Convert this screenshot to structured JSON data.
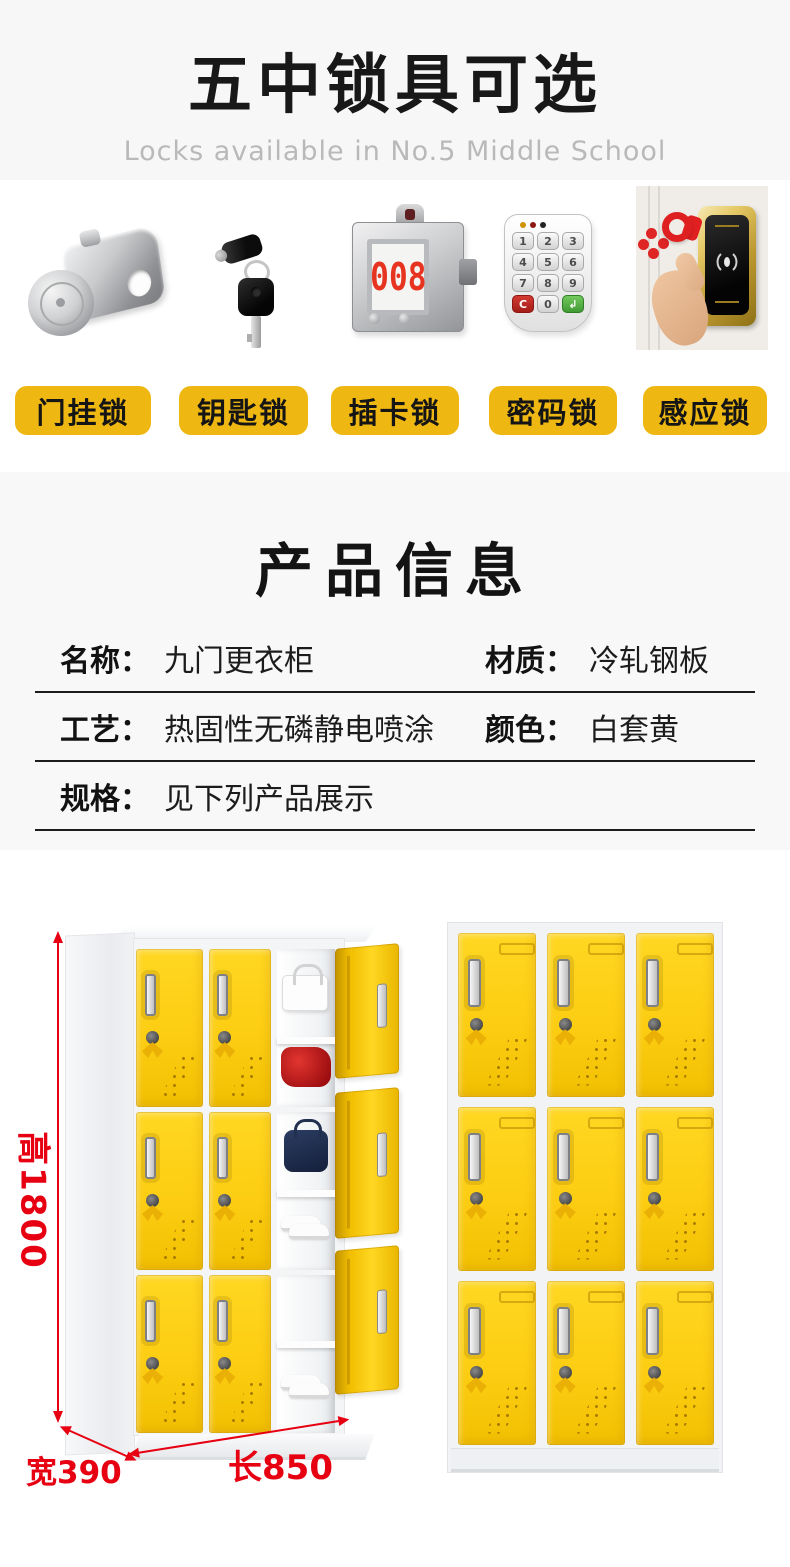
{
  "header": {
    "title": "五中锁具可选",
    "subtitle": "Locks available in No.5 Middle School"
  },
  "locks": {
    "items": [
      {
        "label": "门挂锁",
        "icon": "hasp-lock"
      },
      {
        "label": "钥匙锁",
        "icon": "key-lock"
      },
      {
        "label": "插卡锁",
        "icon": "card-lock"
      },
      {
        "label": "密码锁",
        "icon": "keypad-lock"
      },
      {
        "label": "感应锁",
        "icon": "rfid-lock"
      }
    ],
    "card_lock_number": "008",
    "keypad_keys": [
      "1",
      "2",
      "3",
      "4",
      "5",
      "6",
      "7",
      "8",
      "9",
      "C",
      "0",
      "↲"
    ]
  },
  "product_info": {
    "title": "产品信息",
    "rows": [
      {
        "label": "名称：",
        "value": "九门更衣柜"
      },
      {
        "label": "材质：",
        "value": "冷轧钢板"
      },
      {
        "label": "工艺：",
        "value": "热固性无磷静电喷涂"
      },
      {
        "label": "颜色：",
        "value": "白套黄"
      },
      {
        "label": "规格：",
        "value": "见下列产品展示"
      }
    ]
  },
  "dimensions": {
    "height": "高1800",
    "width": "宽390",
    "length": "长850"
  },
  "colors": {
    "label_yellow": "#EEB711",
    "door_yellow": "#FCCD12",
    "dimension_red": "#E60012",
    "section_bg": "#F8F8F8"
  }
}
